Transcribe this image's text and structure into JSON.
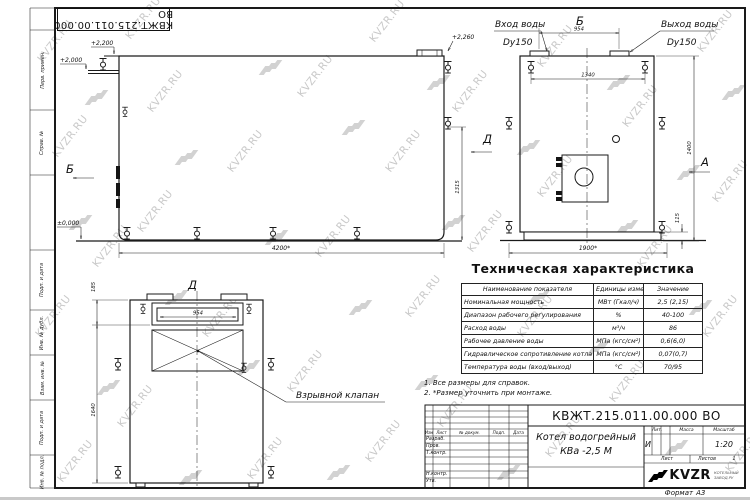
{
  "watermark": {
    "text": "KVZR.RU"
  },
  "margin_labels": [
    "Перв. примен.",
    "Справ. №",
    "Подп. и дата",
    "Инв. № дубл.",
    "Взам. инв. №",
    "Подп. и дата",
    "Инв. № подл."
  ],
  "views": {
    "front": {
      "section_label": "Б",
      "elev_top": "+2,200",
      "elev_pipe": "+2,000",
      "elev_zero": "±0,000",
      "elev_flange": "+2,260",
      "dim_length": "4200*",
      "dim_height": "1315"
    },
    "side": {
      "view_label_top": "Б",
      "view_label_left": "Д",
      "view_label_right": "А",
      "inlet_title": "Вход воды",
      "inlet_dn": "Dy150",
      "outlet_title": "Выход воды",
      "outlet_dn": "Dy150",
      "dim_flanges": "954",
      "dim_pipes": "1340",
      "dim_height": "1400",
      "dim_base": "115",
      "dim_width": "1900*"
    },
    "d_view": {
      "view_label": "Д",
      "dim_top": "185",
      "dim_height": "1640",
      "dim_window": "954",
      "callout": "Взрывной клапан"
    }
  },
  "table": {
    "title": "Техническая характеристика",
    "headers": [
      "Наименование показателя",
      "Единицы измерения",
      "Значение"
    ],
    "rows": [
      [
        "Номинальная мощность",
        "МВт (Гкал/ч)",
        "2,5 (2,15)"
      ],
      [
        "Диапазон рабочего регулирования",
        "%",
        "40-100"
      ],
      [
        "Расход воды",
        "м³/ч",
        "86"
      ],
      [
        "Рабочее давление воды",
        "МПа (кгс/см²)",
        "0,6(6,0)"
      ],
      [
        "Гидравлическое сопротивление котла",
        "МПа (кгс/см²)",
        "0,07(0,7)"
      ],
      [
        "Температура воды (вход/выход)",
        "°С",
        "70/95"
      ]
    ]
  },
  "notes": [
    "1. Все размеры для справок.",
    "2. *Размер уточнить при монтаже."
  ],
  "title_block": {
    "designation": "КВЖТ.215.011.00.000 ВО",
    "name_line1": "Котел водогрейный",
    "name_line2": "КВа -2,5  М",
    "header_izm": "Изм",
    "header_list": "Лист",
    "header_docum": "№ докум.",
    "header_podp": "Подп.",
    "header_data": "Дата",
    "row_razrab": "Разраб.",
    "row_prov": "Пров.",
    "row_tkontr": "Т.контр.",
    "row_nkontr": "Н.контр.",
    "row_utv": "Утв.",
    "lit_label": "Лит.",
    "mass_label": "Масса",
    "scale_label": "Масштаб",
    "lit_value": "И",
    "scale_value": "1:20",
    "sheet_label": "Лист",
    "sheets_label": "Листов",
    "sheets_value": "1",
    "logo_text": "KVZR",
    "logo_sub1": "КОТЕЛЬНЫЙ",
    "logo_sub2": "ЗАВОД.РУ",
    "format_label": "Формат",
    "format_value": "А3"
  }
}
